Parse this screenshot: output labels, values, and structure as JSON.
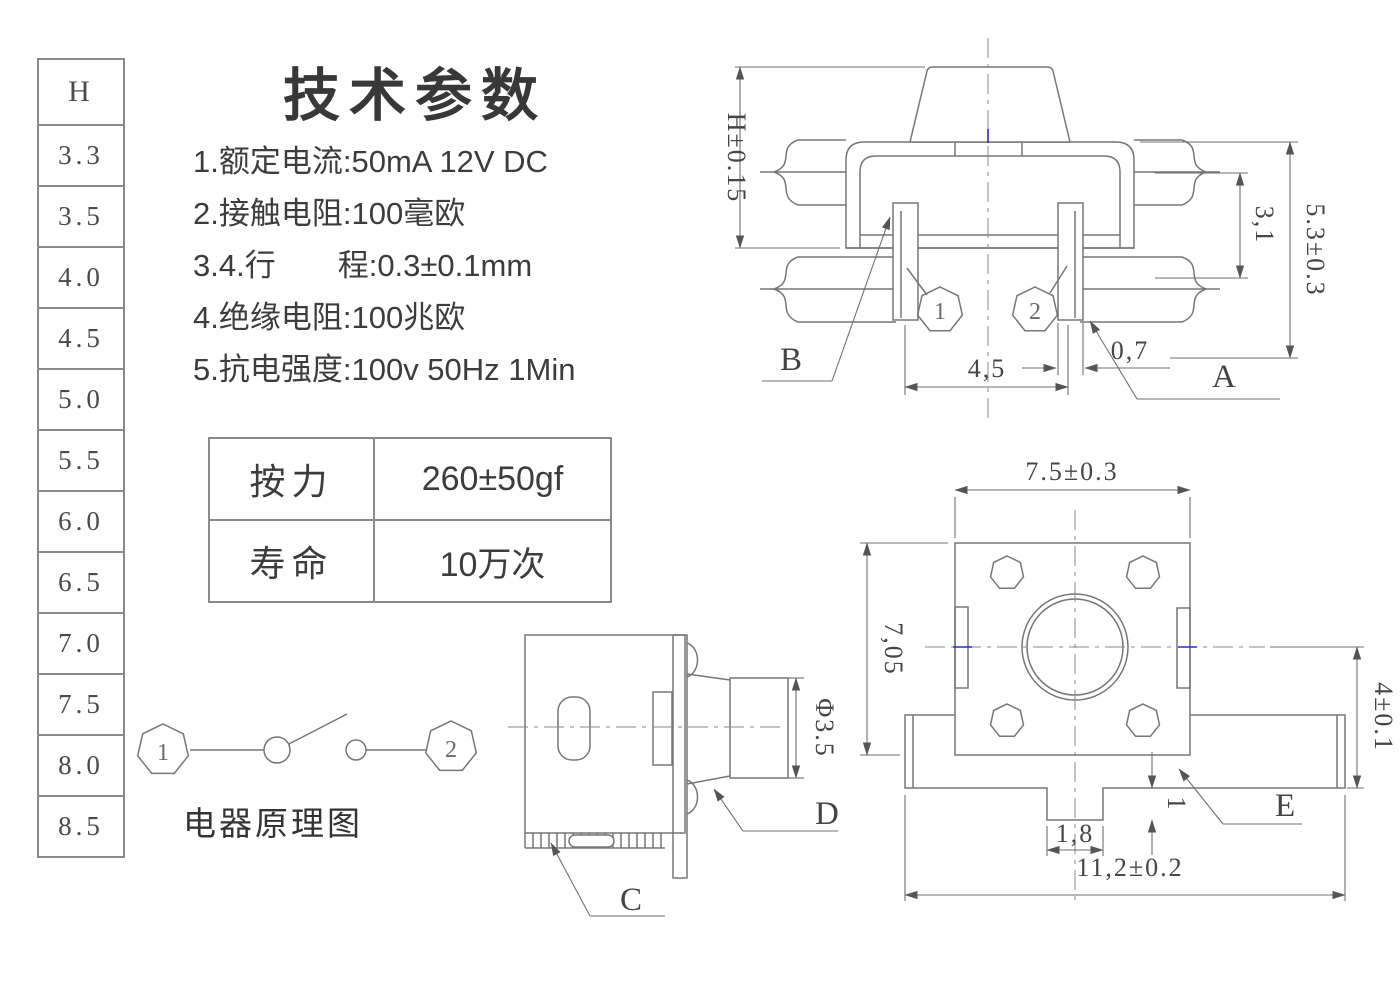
{
  "title": "技术参数",
  "h_table": {
    "header": "H",
    "values": [
      "3.3",
      "3.5",
      "4.0",
      "4.5",
      "5.0",
      "5.5",
      "6.0",
      "6.5",
      "7.0",
      "7.5",
      "8.0",
      "8.5"
    ]
  },
  "specs": [
    "1.额定电流:50mA 12V DC",
    "2.接触电阻:100毫欧",
    "3.4.行　　程:0.3±0.1mm",
    "4.绝缘电阻:100兆欧",
    "5.抗电强度:100v 50Hz 1Min"
  ],
  "params_table": {
    "rows": [
      {
        "label": "按力",
        "value": "260±50gf"
      },
      {
        "label": "寿命",
        "value": "10万次"
      }
    ]
  },
  "schematic": {
    "caption": "电器原理图",
    "terminal_1": "1",
    "terminal_2": "2"
  },
  "front_view": {
    "dims": {
      "height": "H±0.15",
      "total_height": "5.3±0.3",
      "pin_length": "3,1",
      "pin_pitch": "4,5",
      "pin_width": "0,7"
    },
    "labels": {
      "a": "A",
      "b": "B",
      "pin1": "1",
      "pin2": "2"
    }
  },
  "top_view": {
    "dims": {
      "body_width": "7.5±0.3",
      "body_depth": "7,05",
      "tab_offset": "4±0.1",
      "tab_depth": "1",
      "tab_width": "1,8",
      "total_width": "11,2±0.2"
    },
    "labels": {
      "e": "E"
    }
  },
  "side_view": {
    "dims": {
      "stem_diameter": "Φ3.5"
    },
    "labels": {
      "c": "C",
      "d": "D"
    }
  },
  "colors": {
    "line": "#767676",
    "text": "#3c3c3c",
    "accent_blue": "#2a2ac8"
  }
}
